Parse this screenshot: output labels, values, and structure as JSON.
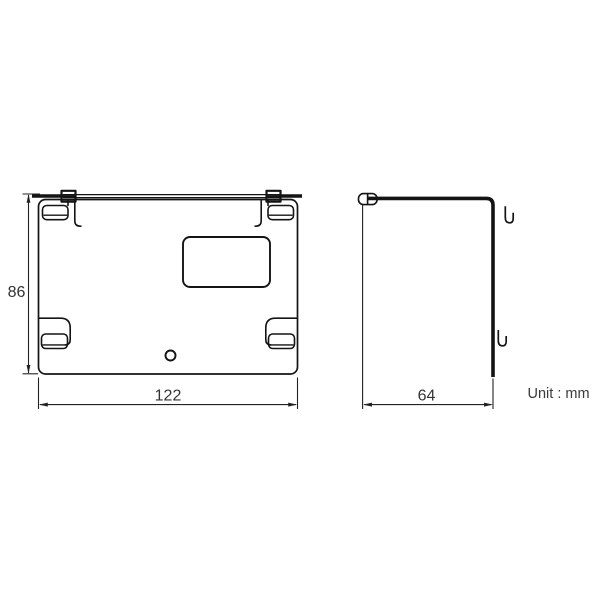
{
  "drawing": {
    "type": "technical-drawing",
    "unit_label": "Unit : mm",
    "line_color": "#141414",
    "dim_text_color": "#333333",
    "unit_text_color": "#3a3a3a",
    "views": [
      {
        "id": "front",
        "label": "front view of mounting bracket plate",
        "height_dim": "86",
        "width_dim": "122"
      },
      {
        "id": "side",
        "label": "side view of mounting bracket profile",
        "depth_dim": "64"
      }
    ]
  }
}
